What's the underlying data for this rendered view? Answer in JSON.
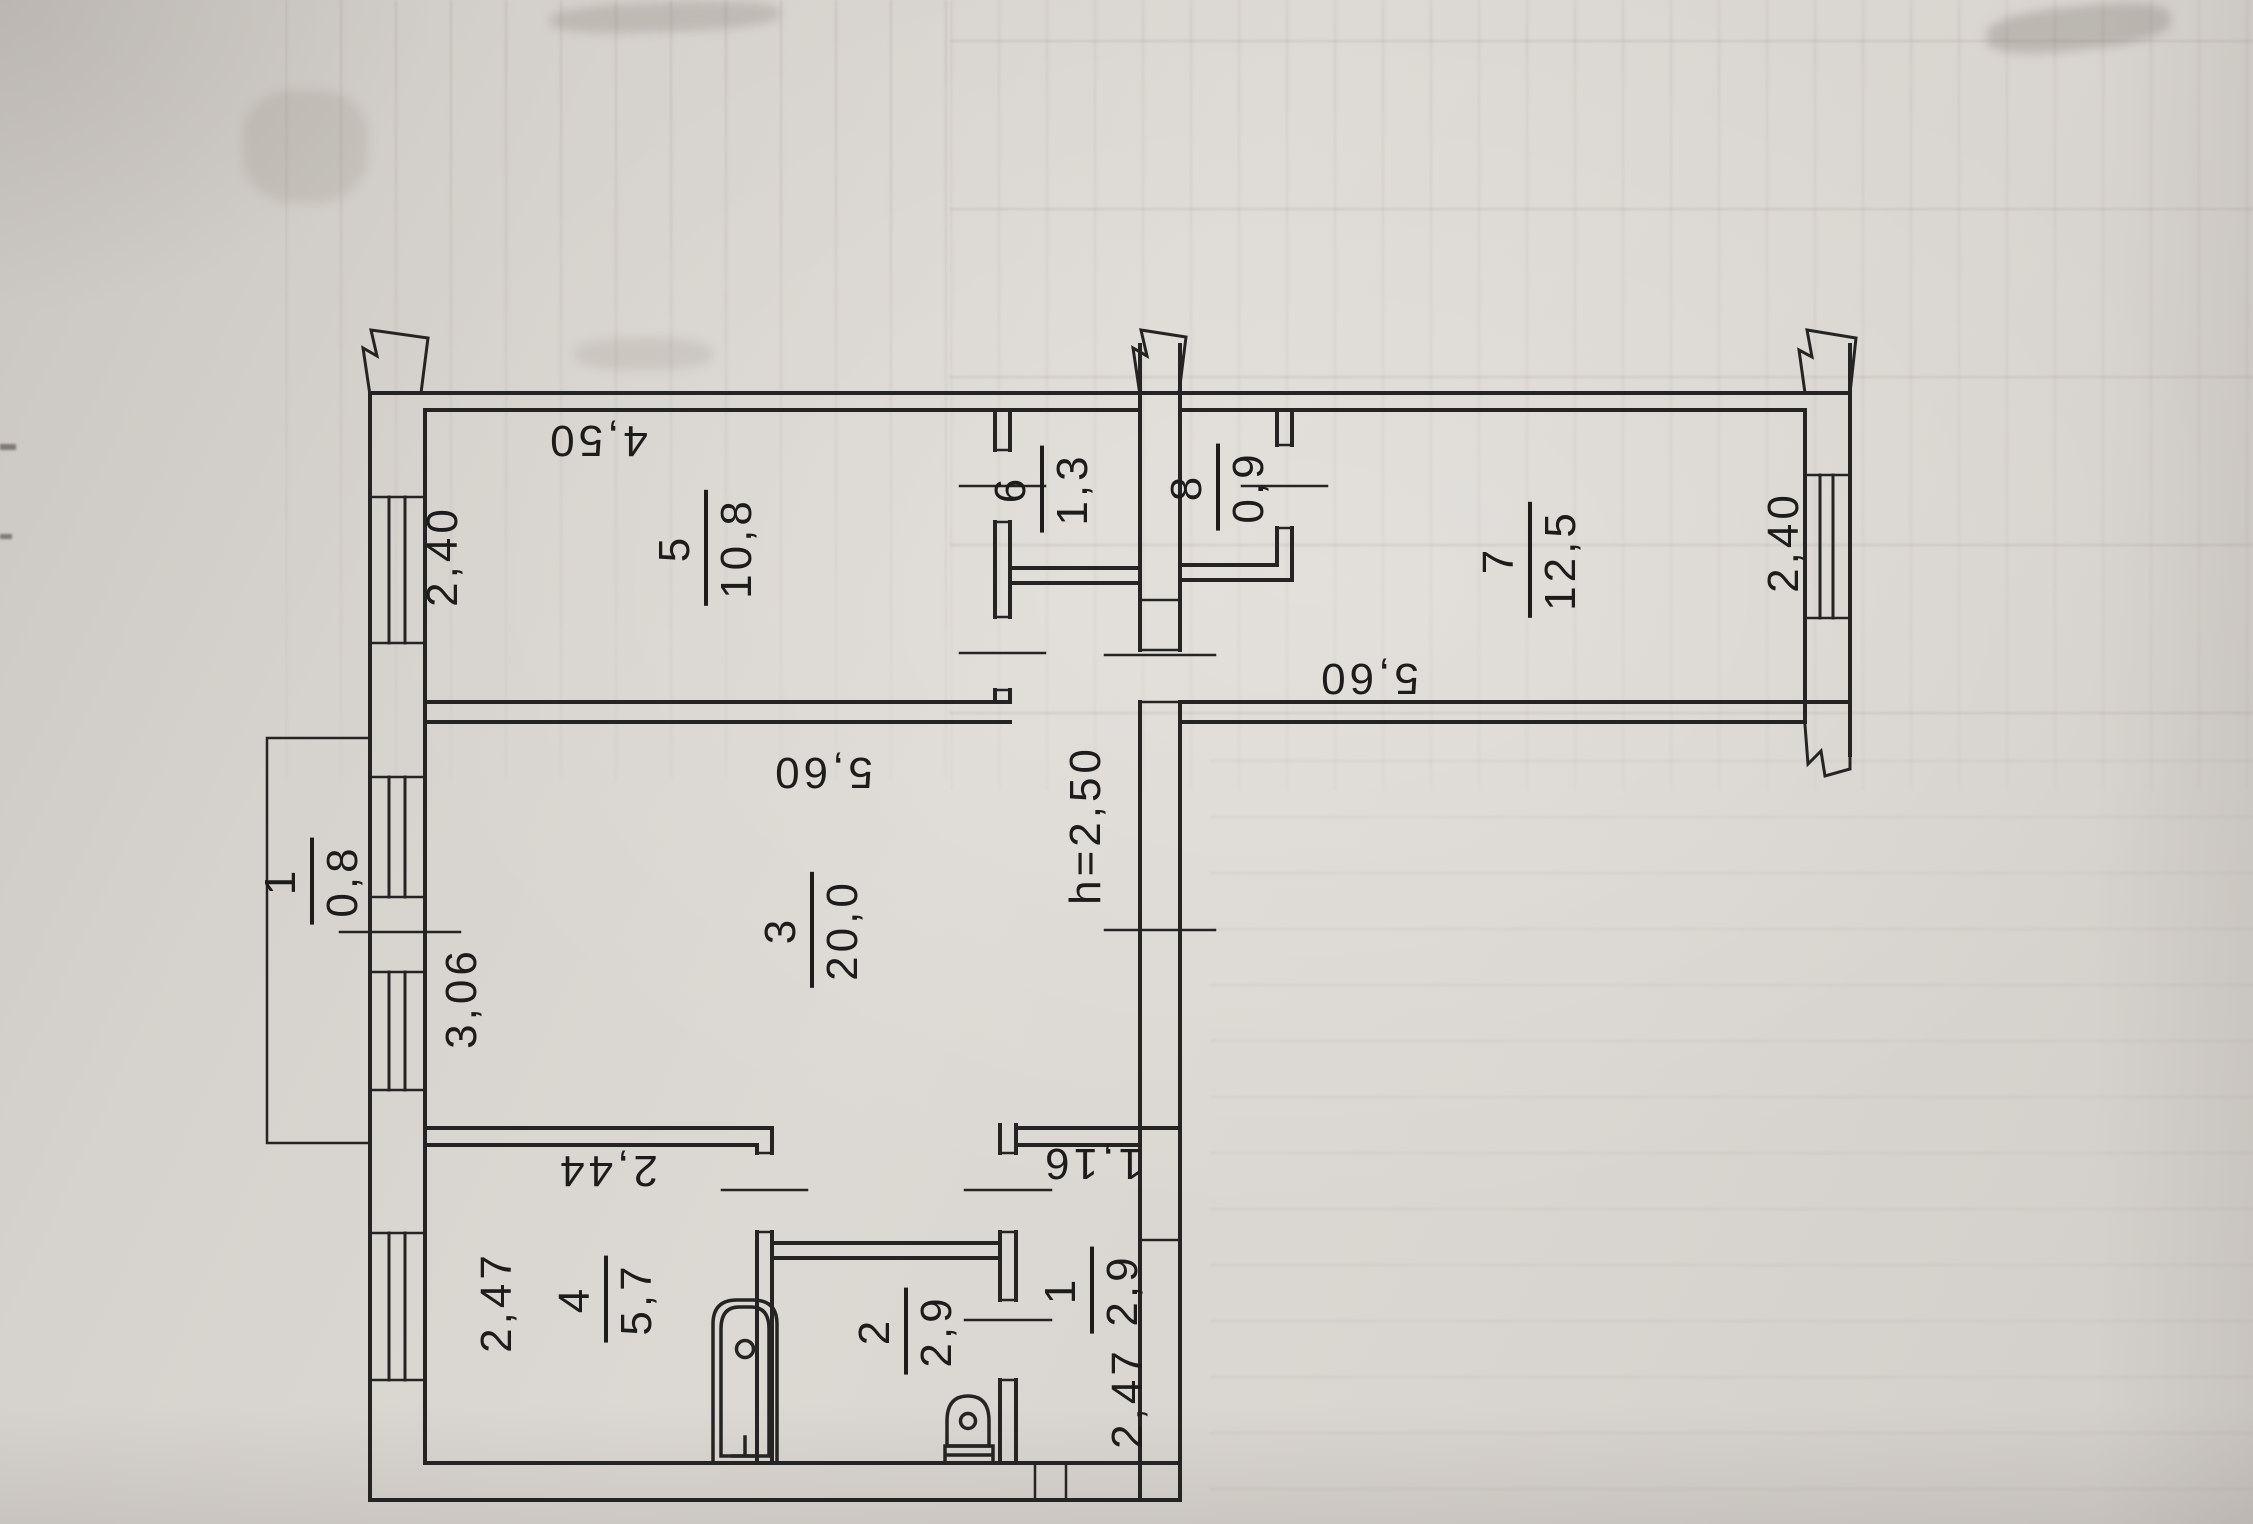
{
  "plan": {
    "rooms": [
      {
        "id": "room-5",
        "number": "5",
        "area": "10,8"
      },
      {
        "id": "room-6",
        "number": "6",
        "area": "1,3"
      },
      {
        "id": "room-8",
        "number": "8",
        "area": "0,9"
      },
      {
        "id": "room-7",
        "number": "7",
        "area": "12,5"
      },
      {
        "id": "room-3",
        "number": "3",
        "area": "20,0"
      },
      {
        "id": "balcony",
        "number": "1",
        "area": "0,8"
      },
      {
        "id": "room-4",
        "number": "4",
        "area": "5,7"
      },
      {
        "id": "room-2",
        "number": "2",
        "area": "2,9"
      },
      {
        "id": "room-1",
        "number": "1",
        "area": "2,9"
      }
    ],
    "dimensions": [
      {
        "id": "dim-top-width",
        "text": "4,50"
      },
      {
        "id": "dim-left-window",
        "text": "2,40"
      },
      {
        "id": "dim-right-window",
        "text": "2,40"
      },
      {
        "id": "dim-room5-bottom",
        "text": "5,60"
      },
      {
        "id": "dim-room7-bottom",
        "text": "5,60"
      },
      {
        "id": "dim-balcony-wall",
        "text": "3,06"
      },
      {
        "id": "dim-room4-width",
        "text": "2,44"
      },
      {
        "id": "dim-room4-depth",
        "text": "2,47"
      },
      {
        "id": "dim-room1-width",
        "text": "1,16"
      },
      {
        "id": "dim-room1-depth",
        "text": "2,47"
      },
      {
        "id": "ceiling-height",
        "text": "h=2,50"
      }
    ]
  }
}
